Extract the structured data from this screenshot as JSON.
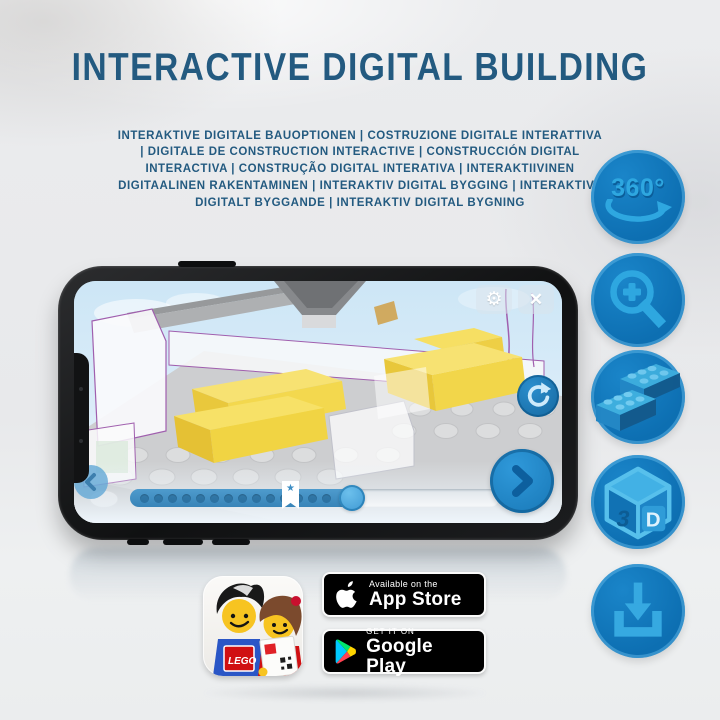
{
  "header": {
    "title": "INTERACTIVE DIGITAL BUILDING",
    "subtitle": "INTERAKTIVE DIGITALE BAUOPTIONEN | COSTRUZIONE DIGITALE INTERATTIVA | DIGITALE DE CONSTRUCTION INTERACTIVE | CONSTRUCCIÓN DIGITAL INTERACTIVA | CONSTRUÇÃO DIGITAL INTERATIVA | INTERAKTIIVINEN DIGITAALINEN RAKENTAMINEN | INTERAKTIV DIGITAL BYGGING | INTERAKTIVT DIGITALT BYGGANDE | INTERAKTIV DIGITAL BYGNING"
  },
  "feature_icons": {
    "rotate_label": "360°",
    "cube_left": "3",
    "cube_right": "D",
    "names": [
      "360-rotation",
      "zoom-in",
      "brick-building",
      "3d-view",
      "download"
    ]
  },
  "phone_app": {
    "glyphs": {
      "gear": "⚙",
      "close": "✕",
      "star": "★"
    },
    "progress_percent": 60
  },
  "app_icon": {
    "logo_text": "LEGO"
  },
  "badges": {
    "app_store": {
      "tagline": "Available on the",
      "store": "App Store"
    },
    "google_play": {
      "tagline": "GET IT ON",
      "store": "Google Play"
    }
  },
  "colors": {
    "title_blue": "#235a80",
    "circle_blue": "#0d6fb2",
    "icon_light_blue": "#2ea7e0",
    "brick_yellow": "#f2d64b",
    "screen_sky": "#d6e9f7"
  }
}
